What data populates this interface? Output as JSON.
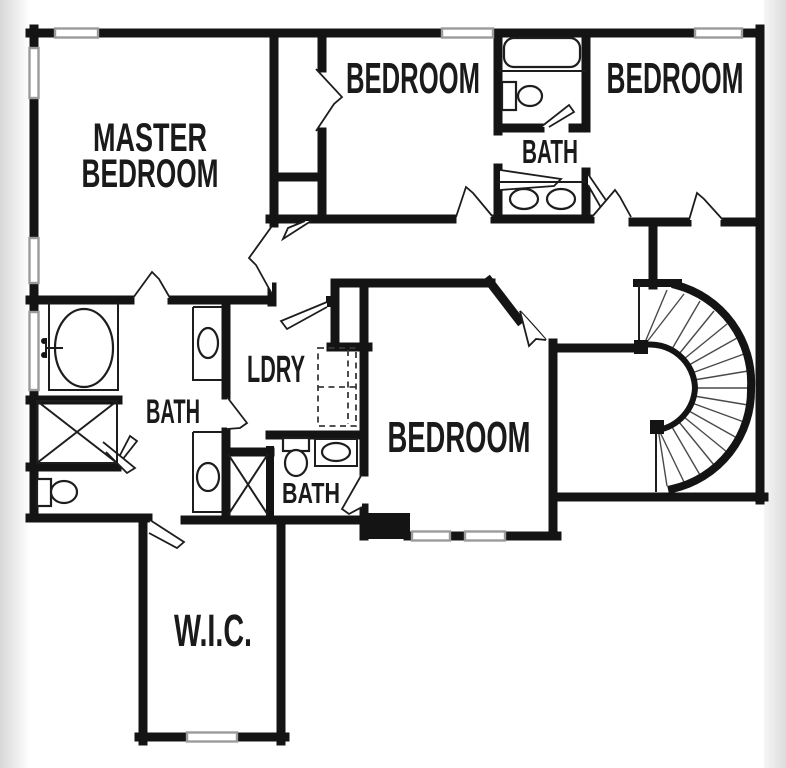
{
  "plan": {
    "rooms": {
      "master_bedroom": {
        "label_line1": "MASTER",
        "label_line2": "BEDROOM"
      },
      "bedroom_top_middle": {
        "label": "BEDROOM"
      },
      "bath_top": {
        "label": "BATH"
      },
      "bedroom_top_right": {
        "label": "BEDROOM"
      },
      "bath_master": {
        "label": "BATH"
      },
      "laundry": {
        "label": "LDRY"
      },
      "bedroom_center": {
        "label": "BEDROOM"
      },
      "bath_hall": {
        "label": "BATH"
      },
      "walk_in_closet": {
        "label": "W.I.C."
      }
    },
    "colors": {
      "wall": "#141414",
      "window": "#9b9b9b",
      "fixture_outline": "#1d1d1d",
      "paper": "#ffffff",
      "photo_edge": "#d9d9d9"
    }
  }
}
